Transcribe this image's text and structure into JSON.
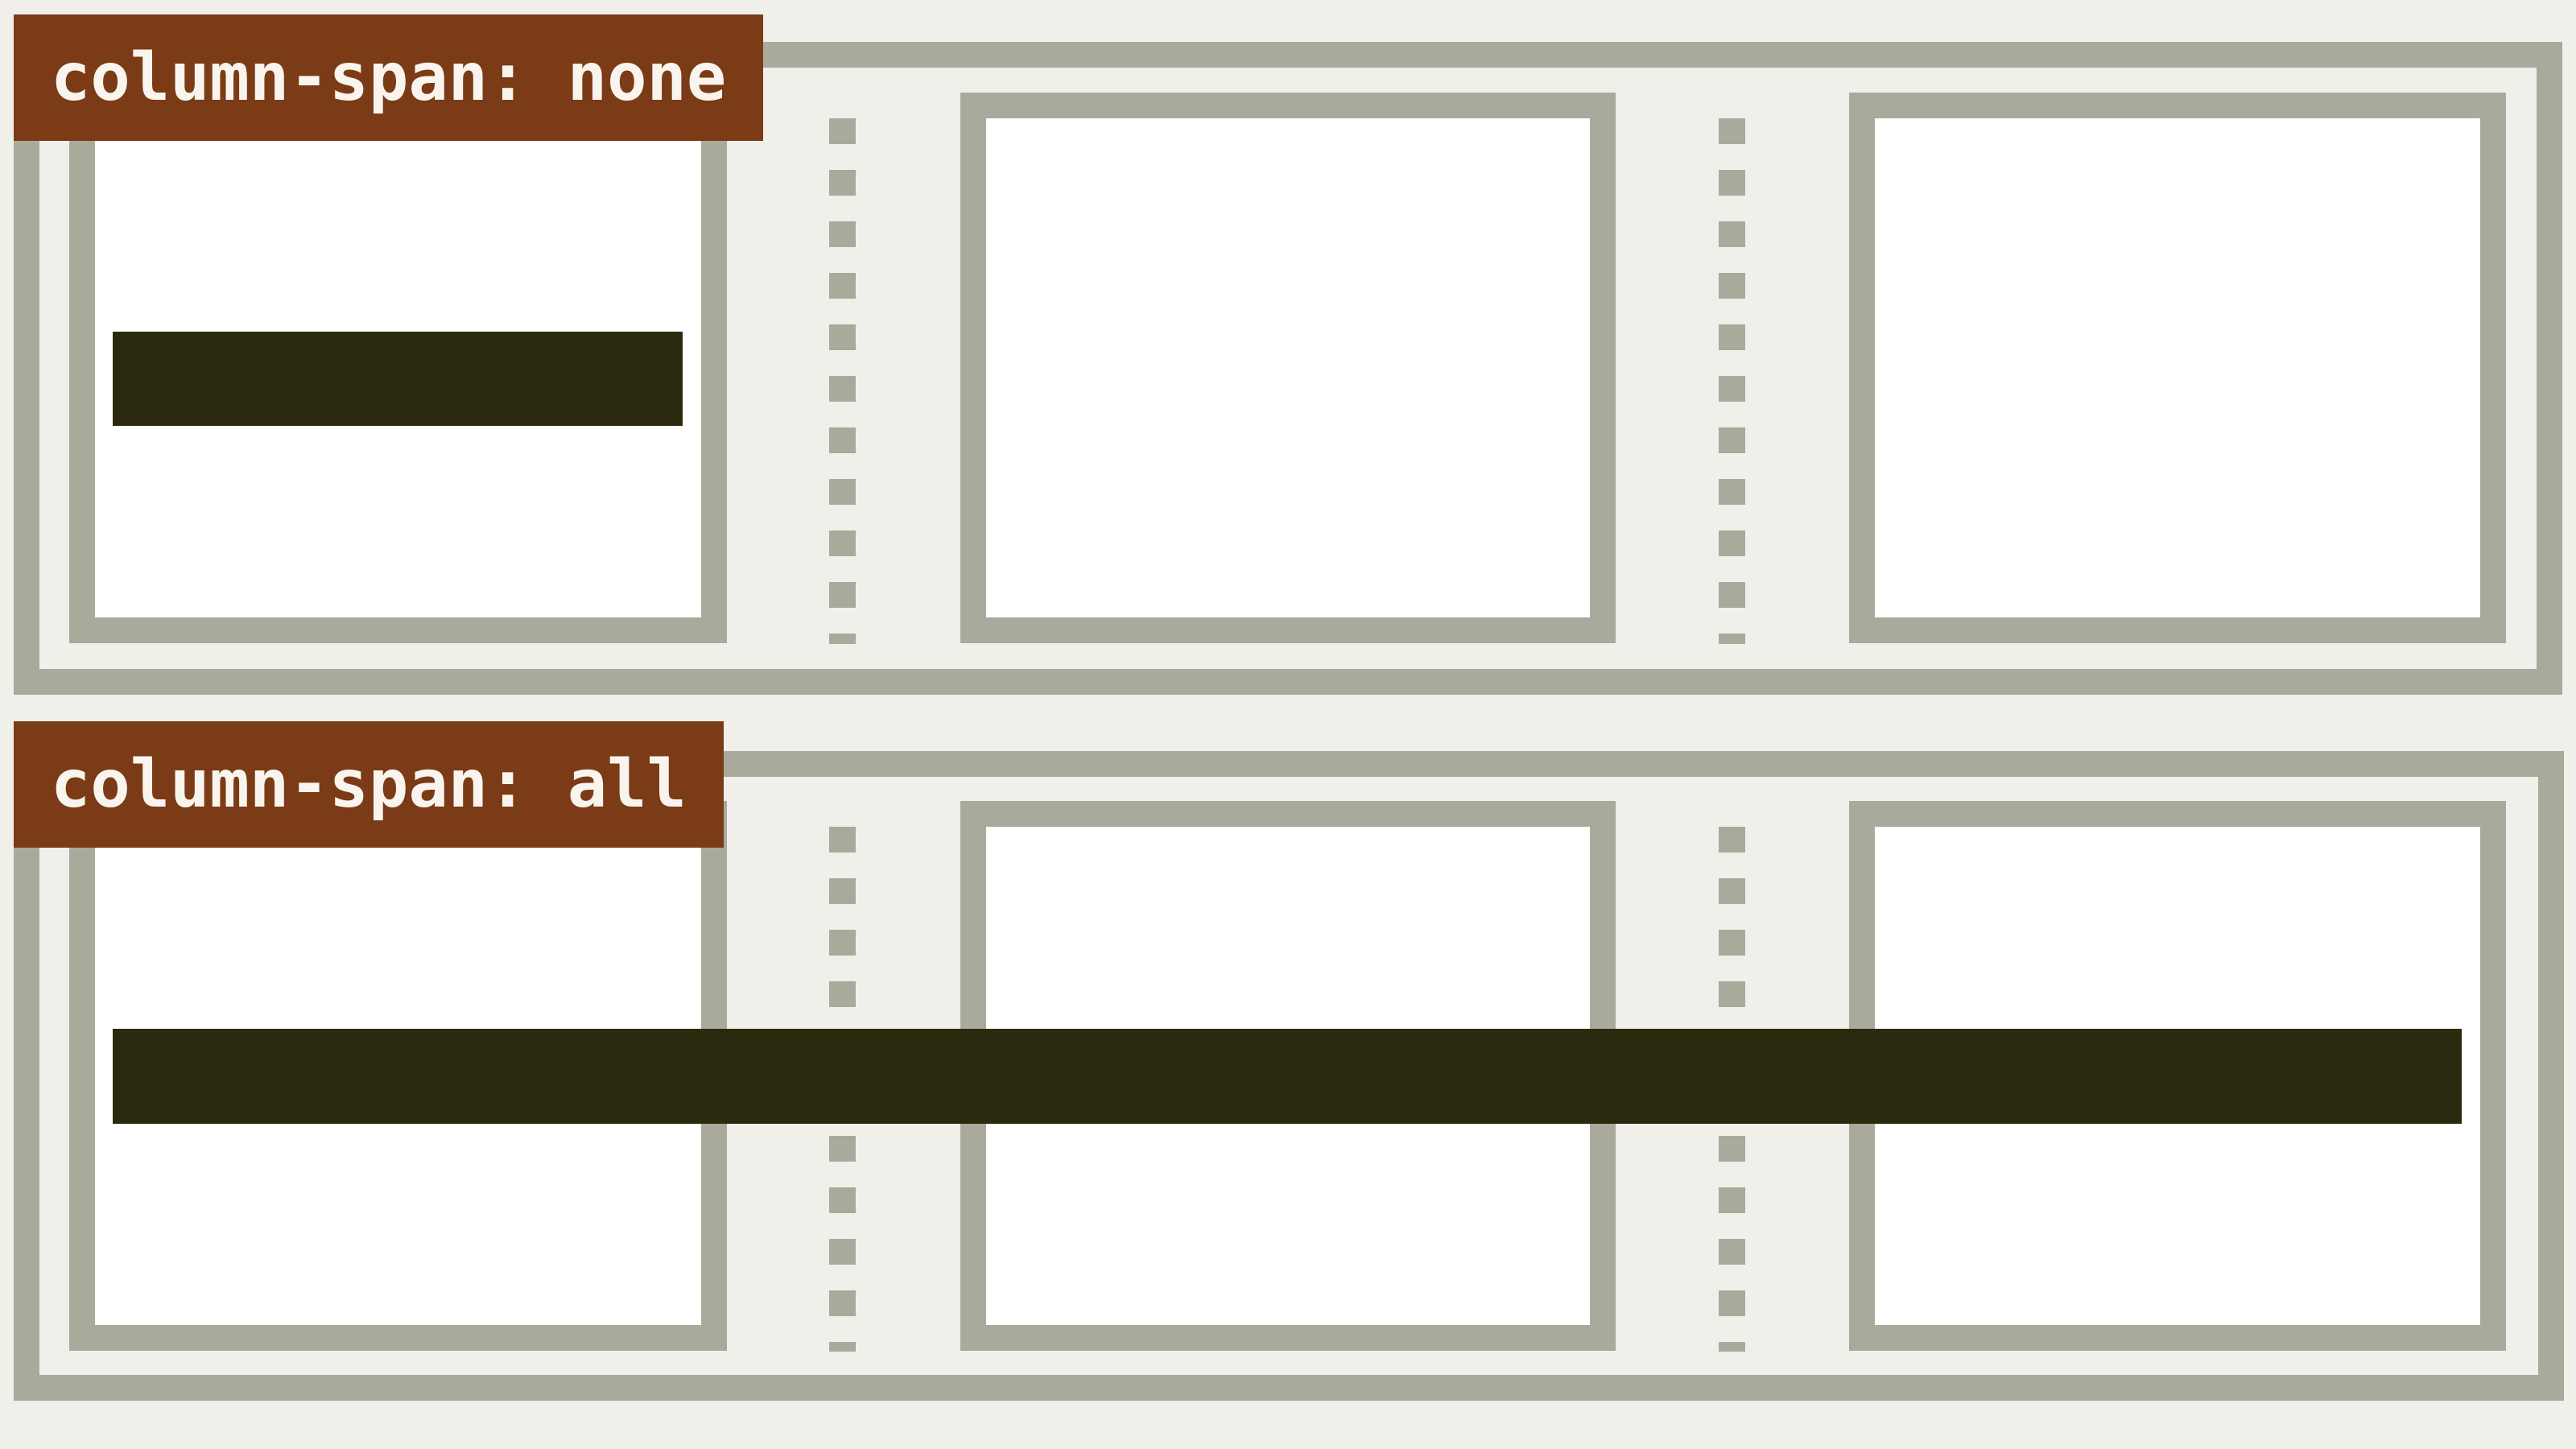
{
  "diagram": {
    "title_context": "CSS column-span illustration",
    "panels": [
      {
        "label": "column-span: none",
        "columns": 3,
        "bar_spans_columns": 1
      },
      {
        "label": "column-span: all",
        "columns": 3,
        "bar_spans_columns": 3
      }
    ]
  },
  "colors": {
    "page_background": "#f0efea",
    "frame_border": "#a9aa9c",
    "column_box_fill": "#ffffff",
    "column_rule_dash": "#a9aa9c",
    "spanning_bar": "#2c2a0e",
    "label_background": "#7a3b16",
    "label_text": "#f9f5ee"
  }
}
